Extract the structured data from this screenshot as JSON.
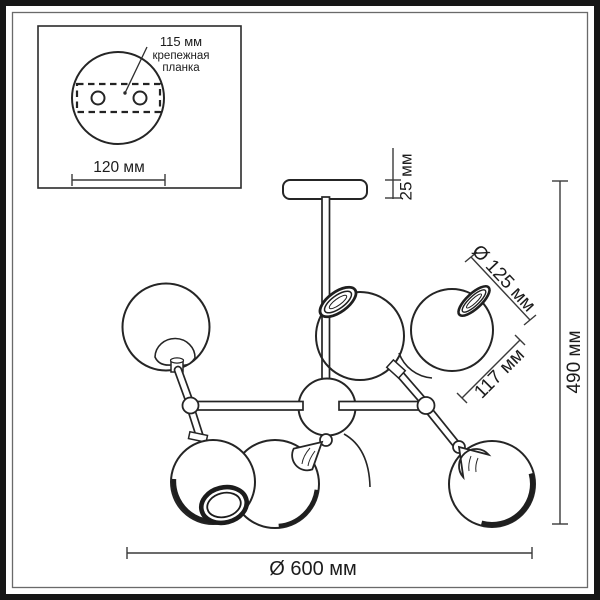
{
  "inset": {
    "hole_spacing_label": "115 мм",
    "bracket_label_line1": "крепежная",
    "bracket_label_line2": "планка",
    "plate_width_label": "120 мм"
  },
  "dimensions": {
    "canopy_height": "25 мм",
    "shade_diameter": "Ø 125 мм",
    "shade_length": "117 мм",
    "fixture_height": "490 мм",
    "fixture_diameter": "Ø 600 мм"
  },
  "colors": {
    "background": "#ffffff",
    "line": "#252525",
    "frame": "#161616",
    "dimension_line": "#3a3a3a"
  }
}
